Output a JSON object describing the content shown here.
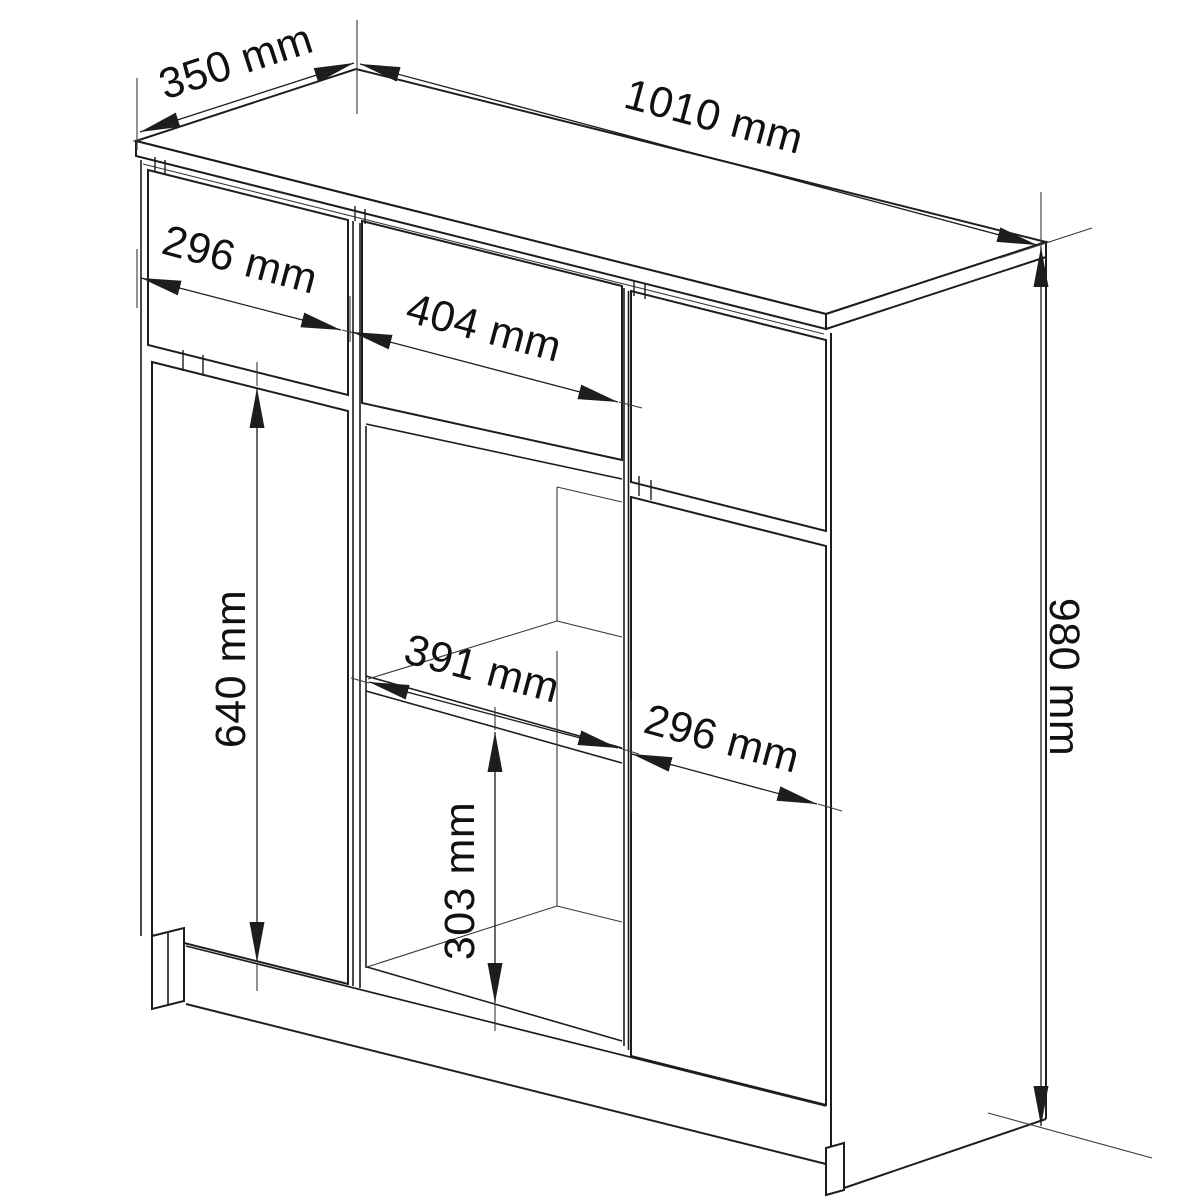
{
  "diagram": {
    "kind": "furniture technical dimension drawing",
    "object": "sideboard with drawers, doors and open shelf niche",
    "unit": "mm",
    "background_color": "#ffffff",
    "line_color": "#1d1d1d",
    "text_color": "#111111",
    "dims": {
      "depth": "350 mm",
      "total_width": "1010 mm",
      "left_drawer_width": "296 mm",
      "middle_drawer_width": "404 mm",
      "left_door_height": "640 mm",
      "niche_width": "391 mm",
      "right_door_width": "296 mm",
      "lower_compartment_height": "303 mm",
      "total_height": "980 mm"
    },
    "values_mm": {
      "depth": 350,
      "total_width": 1010,
      "left_drawer_width": 296,
      "middle_drawer_width": 404,
      "left_door_height": 640,
      "niche_width": 391,
      "right_door_width": 296,
      "lower_compartment_height": 303,
      "total_height": 980
    }
  }
}
